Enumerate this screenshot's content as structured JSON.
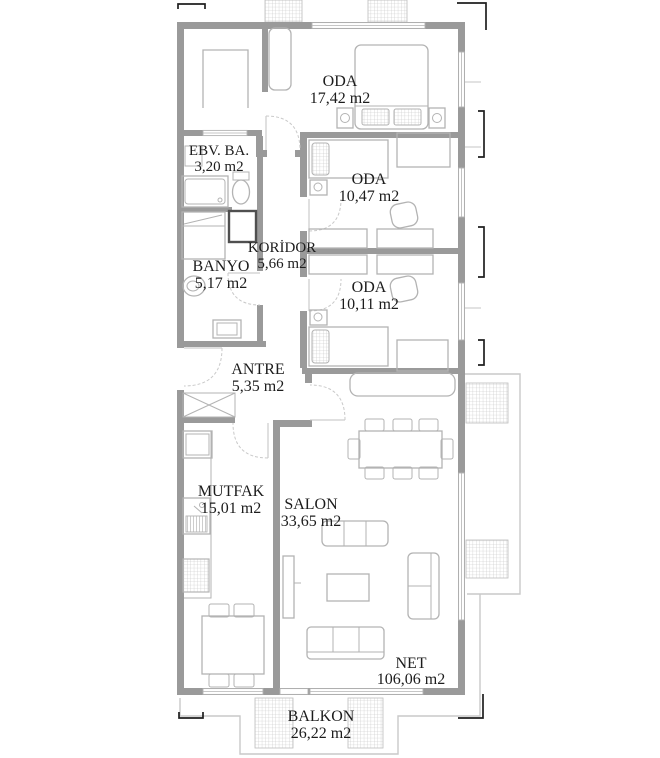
{
  "colors": {
    "wall": "#9a9a9a",
    "furniture": "#b3b3b3",
    "text": "#1c1c1c",
    "dimension": "#1f1f1f",
    "shower_dark": "#4f4f4f",
    "balcony_outline": "#c9c9c9",
    "background": "#ffffff"
  },
  "plan": {
    "type": "apartment-floor-plan",
    "unit_suffix": "m2"
  },
  "rooms": [
    {
      "id": "oda-master",
      "name": "ODA",
      "area": "17,42 m2"
    },
    {
      "id": "ebv-ba",
      "name": "EBV. BA.",
      "area": "3,20 m2"
    },
    {
      "id": "oda-2",
      "name": "ODA",
      "area": "10,47 m2"
    },
    {
      "id": "koridor",
      "name": "KORİDOR",
      "area": "5,66 m2"
    },
    {
      "id": "banyo",
      "name": "BANYO",
      "area": "5,17 m2"
    },
    {
      "id": "oda-3",
      "name": "ODA",
      "area": "10,11 m2"
    },
    {
      "id": "antre",
      "name": "ANTRE",
      "area": "5,35 m2"
    },
    {
      "id": "mutfak",
      "name": "MUTFAK",
      "area": "15,01 m2"
    },
    {
      "id": "salon",
      "name": "SALON",
      "area": "33,65 m2"
    },
    {
      "id": "net",
      "name": "NET",
      "area": "106,06 m2"
    },
    {
      "id": "balkon",
      "name": "BALKON",
      "area": "26,22 m2"
    }
  ]
}
